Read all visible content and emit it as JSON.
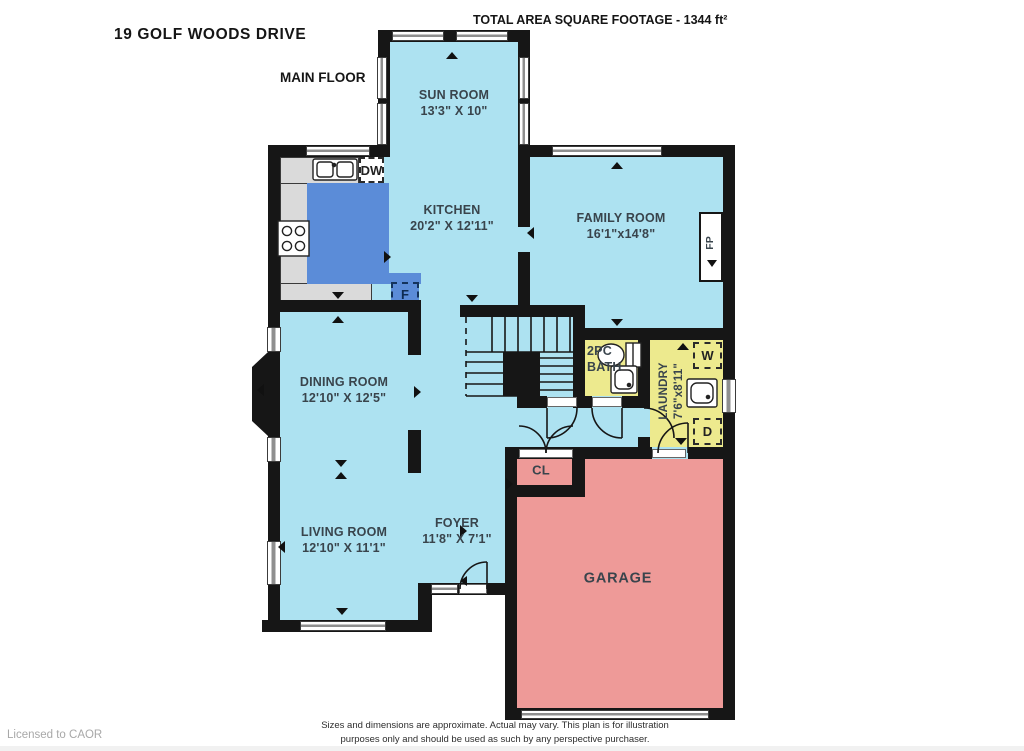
{
  "header": {
    "address": "19 GOLF WOODS DRIVE",
    "floor_label": "MAIN FLOOR",
    "total_area": "TOTAL AREA SQUARE FOOTAGE - 1344 ft²"
  },
  "rooms": {
    "sun_room": {
      "name": "SUN ROOM",
      "dims": "13'3\" X 10\""
    },
    "kitchen": {
      "name": "KITCHEN",
      "dims": "20'2\" X 12'11\""
    },
    "family_room": {
      "name": "FAMILY ROOM",
      "dims": "16'1\"x14'8\""
    },
    "dining_room": {
      "name": "DINING ROOM",
      "dims": "12'10\" X 12'5\""
    },
    "living_room": {
      "name": "LIVING ROOM",
      "dims": "12'10\" X 11'1\""
    },
    "foyer": {
      "name": "FOYER",
      "dims": "11'8\" X 7'1\""
    },
    "bath": {
      "name_line1": "2PC",
      "name_line2": "BATH"
    },
    "laundry": {
      "name": "LAUNDRY",
      "dims": "7'6\"x8'11\""
    },
    "garage": {
      "name": "GARAGE"
    },
    "closet": {
      "name": "CL"
    }
  },
  "fixtures": {
    "dishwasher": "DW",
    "fridge": "F",
    "washer": "W",
    "dryer": "D",
    "fireplace": "FP"
  },
  "footer": {
    "disclaimer_line1": "Sizes and dimensions are approximate. Actual may vary. This plan is for illustration",
    "disclaimer_line2": "purposes only and should be used as such by any perspective purchaser.",
    "license": "Licensed to CAOR"
  },
  "colors": {
    "floor_blue": "#ade2f1",
    "island_blue": "#5b8cd8",
    "wet_room_yellow": "#edea8e",
    "garage_pink": "#ee9a98",
    "counter_gray": "#dadada",
    "wall_black": "#161616"
  }
}
